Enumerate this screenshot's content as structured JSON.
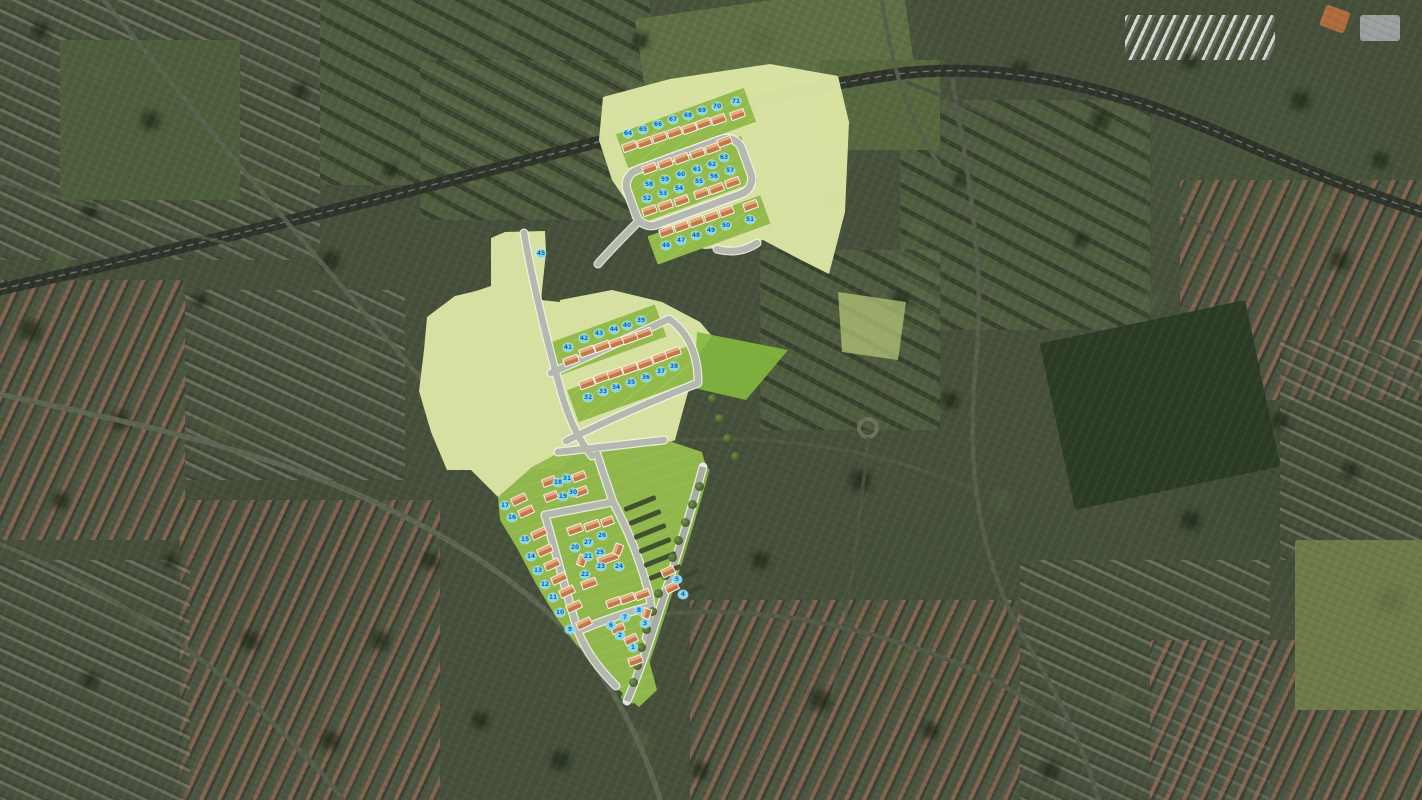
{
  "map": {
    "type": "aerial-masterplan",
    "colors": {
      "overlay_pale": "#dde7a5",
      "plot_green": "#93bb4c",
      "bright_green": "#84b83e",
      "road_gray": "#b4b8ae",
      "house_roof_light": "#e4ac7d",
      "house_roof_dark": "#c2794a",
      "badge_bg": "#85d7ef",
      "badge_text": "#1266a8"
    }
  },
  "site_plan": {
    "clusters": [
      {
        "name": "access-strip",
        "rows": [
          {
            "plots": [
              {
                "n": "45",
                "x": 541,
                "y": 253
              }
            ]
          }
        ]
      },
      {
        "name": "north-parcel",
        "rows": [
          {
            "house": {
              "dx": 1,
              "dy": 13,
              "w": 15,
              "h": 9,
              "rot": -20
            },
            "plots": [
              {
                "n": "64",
                "x": 628,
                "y": 133
              },
              {
                "n": "65",
                "x": 643,
                "y": 129
              },
              {
                "n": "66",
                "x": 658,
                "y": 124
              },
              {
                "n": "67",
                "x": 673,
                "y": 119
              },
              {
                "n": "68",
                "x": 688,
                "y": 115
              },
              {
                "n": "69",
                "x": 702,
                "y": 110
              },
              {
                "n": "70",
                "x": 717,
                "y": 106
              },
              {
                "n": "71",
                "x": 736,
                "y": 101
              }
            ]
          },
          {
            "house": {
              "dx": 0,
              "dy": -16,
              "w": 15,
              "h": 9,
              "rot": -20
            },
            "plots": [
              {
                "n": "58",
                "x": 649,
                "y": 184
              },
              {
                "n": "59",
                "x": 665,
                "y": 179
              },
              {
                "n": "60",
                "x": 681,
                "y": 174
              },
              {
                "n": "61",
                "x": 697,
                "y": 169
              },
              {
                "n": "62",
                "x": 712,
                "y": 164
              },
              {
                "n": "63",
                "x": 724,
                "y": 157
              }
            ]
          },
          {
            "house": {
              "dx": 2,
              "dy": 12,
              "w": 15,
              "h": 9,
              "rot": -20
            },
            "plots": [
              {
                "n": "52",
                "x": 647,
                "y": 198
              },
              {
                "n": "53",
                "x": 663,
                "y": 193
              },
              {
                "n": "54",
                "x": 679,
                "y": 188
              },
              {
                "n": "55",
                "x": 699,
                "y": 181
              },
              {
                "n": "56",
                "x": 714,
                "y": 176
              },
              {
                "n": "57",
                "x": 730,
                "y": 170
              }
            ]
          },
          {
            "house": {
              "dx": 0,
              "dy": -14,
              "w": 15,
              "h": 9,
              "rot": -20
            },
            "plots": [
              {
                "n": "46",
                "x": 666,
                "y": 245
              },
              {
                "n": "47",
                "x": 681,
                "y": 240
              },
              {
                "n": "48",
                "x": 696,
                "y": 235
              },
              {
                "n": "49",
                "x": 711,
                "y": 230
              },
              {
                "n": "50",
                "x": 726,
                "y": 225
              },
              {
                "n": "51",
                "x": 750,
                "y": 219
              }
            ]
          }
        ]
      },
      {
        "name": "middle-parcel",
        "rows": [
          {
            "house": {
              "dx": 3,
              "dy": 13,
              "w": 16,
              "h": 9,
              "rot": -20
            },
            "plots": [
              {
                "n": "41",
                "x": 568,
                "y": 347
              },
              {
                "n": "42",
                "x": 584,
                "y": 338
              },
              {
                "n": "43",
                "x": 599,
                "y": 333
              },
              {
                "n": "44",
                "x": 614,
                "y": 329
              },
              {
                "n": "40",
                "x": 627,
                "y": 325
              },
              {
                "n": "39",
                "x": 641,
                "y": 320
              }
            ]
          },
          {
            "house": {
              "dx": -1,
              "dy": -14,
              "w": 16,
              "h": 9,
              "rot": -20
            },
            "plots": [
              {
                "n": "32",
                "x": 588,
                "y": 397
              },
              {
                "n": "33",
                "x": 603,
                "y": 391
              },
              {
                "n": "34",
                "x": 616,
                "y": 387
              },
              {
                "n": "35",
                "x": 631,
                "y": 382
              },
              {
                "n": "36",
                "x": 646,
                "y": 377
              },
              {
                "n": "37",
                "x": 661,
                "y": 371
              },
              {
                "n": "38",
                "x": 674,
                "y": 366
              }
            ]
          }
        ]
      },
      {
        "name": "south-parcel",
        "rows": [
          {
            "house": {
              "dx": 14,
              "dy": -6,
              "w": 16,
              "h": 9,
              "rot": -25
            },
            "plots": [
              {
                "n": "17",
                "x": 505,
                "y": 505
              },
              {
                "n": "16",
                "x": 512,
                "y": 517
              },
              {
                "n": "15",
                "x": 525,
                "y": 539
              },
              {
                "n": "14",
                "x": 531,
                "y": 556
              },
              {
                "n": "13",
                "x": 538,
                "y": 570
              },
              {
                "n": "12",
                "x": 545,
                "y": 584
              },
              {
                "n": "11",
                "x": 553,
                "y": 597
              },
              {
                "n": "10",
                "x": 560,
                "y": 612
              },
              {
                "n": "9",
                "x": 570,
                "y": 629
              }
            ]
          },
          {
            "plots": [
              {
                "n": "18",
                "x": 558,
                "y": 482
              },
              {
                "n": "31",
                "x": 567,
                "y": 478
              },
              {
                "n": "19",
                "x": 563,
                "y": 496
              },
              {
                "n": "30",
                "x": 573,
                "y": 492
              }
            ]
          },
          {
            "plots": [
              {
                "n": "26",
                "x": 602,
                "y": 535
              },
              {
                "n": "27",
                "x": 588,
                "y": 542
              },
              {
                "n": "20",
                "x": 575,
                "y": 547
              },
              {
                "n": "25",
                "x": 600,
                "y": 552
              },
              {
                "n": "21",
                "x": 588,
                "y": 556
              },
              {
                "n": "23",
                "x": 601,
                "y": 566
              },
              {
                "n": "24",
                "x": 619,
                "y": 566
              },
              {
                "n": "22",
                "x": 585,
                "y": 574
              }
            ]
          },
          {
            "plots": [
              {
                "n": "5",
                "x": 677,
                "y": 579
              },
              {
                "n": "4",
                "x": 683,
                "y": 594
              },
              {
                "n": "8",
                "x": 639,
                "y": 610
              },
              {
                "n": "7",
                "x": 625,
                "y": 617
              },
              {
                "n": "6",
                "x": 611,
                "y": 625
              },
              {
                "n": "3",
                "x": 645,
                "y": 623
              },
              {
                "n": "2",
                "x": 620,
                "y": 635
              },
              {
                "n": "1",
                "x": 633,
                "y": 647
              }
            ]
          }
        ]
      }
    ],
    "houses": [
      [
        549,
        481,
        -20,
        14
      ],
      [
        579,
        476,
        -20,
        14
      ],
      [
        551,
        496,
        -20,
        14
      ],
      [
        581,
        491,
        -20,
        14
      ],
      [
        575,
        529,
        -20,
        16
      ],
      [
        592,
        525,
        -20,
        16
      ],
      [
        607,
        521,
        -20,
        13
      ],
      [
        582,
        560,
        -70,
        12
      ],
      [
        608,
        558,
        -20,
        22
      ],
      [
        589,
        583,
        -20,
        16
      ],
      [
        618,
        549,
        -70,
        12
      ],
      [
        613,
        602,
        -20,
        15
      ],
      [
        627,
        598,
        -20,
        15
      ],
      [
        642,
        594,
        -20,
        15
      ],
      [
        668,
        571,
        -25,
        14
      ],
      [
        672,
        587,
        -25,
        14
      ],
      [
        646,
        613,
        -70,
        11
      ],
      [
        618,
        628,
        -20,
        14
      ],
      [
        631,
        639,
        -25,
        14
      ],
      [
        635,
        660,
        -20,
        15
      ]
    ],
    "hedges": [
      [
        640,
        503,
        34,
        -22
      ],
      [
        645,
        517,
        34,
        -22
      ],
      [
        650,
        531,
        34,
        -22
      ],
      [
        655,
        545,
        34,
        -22
      ],
      [
        660,
        559,
        34,
        -22
      ],
      [
        665,
        572,
        34,
        -22
      ],
      [
        691,
        573,
        18,
        -25
      ],
      [
        695,
        589,
        18,
        -25
      ]
    ],
    "trees": [
      [
        699,
        486
      ],
      [
        692,
        504
      ],
      [
        685,
        522
      ],
      [
        678,
        540
      ],
      [
        672,
        557
      ],
      [
        665,
        575
      ],
      [
        658,
        593
      ],
      [
        652,
        611
      ],
      [
        646,
        629
      ],
      [
        641,
        647
      ],
      [
        637,
        665
      ],
      [
        633,
        682
      ],
      [
        712,
        398
      ],
      [
        719,
        418
      ],
      [
        727,
        438
      ],
      [
        735,
        456
      ]
    ]
  }
}
